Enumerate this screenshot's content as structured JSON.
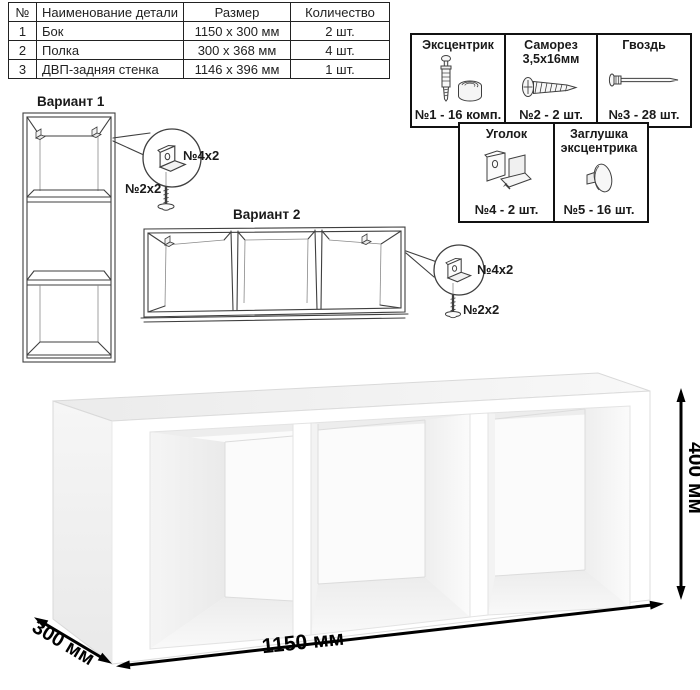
{
  "parts_table": {
    "headers": [
      "№",
      "Наименование детали",
      "Размер",
      "Количество"
    ],
    "rows": [
      {
        "num": "1",
        "name": "Бок",
        "size": "1150 х 300 мм",
        "qty": "2 шт."
      },
      {
        "num": "2",
        "name": "Полка",
        "size": "300 х 368 мм",
        "qty": "4 шт."
      },
      {
        "num": "3",
        "name": "ДВП-задняя стенка",
        "size": "1146 х 396 мм",
        "qty": "1 шт."
      }
    ]
  },
  "hardware_box": {
    "cells": [
      {
        "name": "Эксцентрик",
        "icon": "cam-bolt-and-lock-icon",
        "qty": "№1 - 16 комп."
      },
      {
        "name": "Саморез 3,5х16мм",
        "icon": "screw-icon",
        "qty": "№2 - 2 шт."
      },
      {
        "name": "Гвоздь",
        "icon": "nail-icon",
        "qty": "№3 - 28 шт."
      },
      {
        "name": "Уголок",
        "icon": "corner-bracket-icon",
        "qty": "№4 - 2 шт."
      },
      {
        "name": "Заглушка эксцентрика",
        "icon": "cam-cap-icon",
        "qty": "№5 - 16 шт."
      }
    ]
  },
  "variants": {
    "variant1_title": "Вариант 1",
    "variant2_title": "Вариант 2",
    "bracket_qty_label": "№4х2",
    "screw_qty_label": "№2х2"
  },
  "dimensions": {
    "width_label": "1150 мм",
    "height_label": "400 мм",
    "depth_label": "300 мм"
  },
  "colors": {
    "line_art": "#3f3f3f",
    "dimension_arrows": "#000000",
    "border": "#111111"
  }
}
